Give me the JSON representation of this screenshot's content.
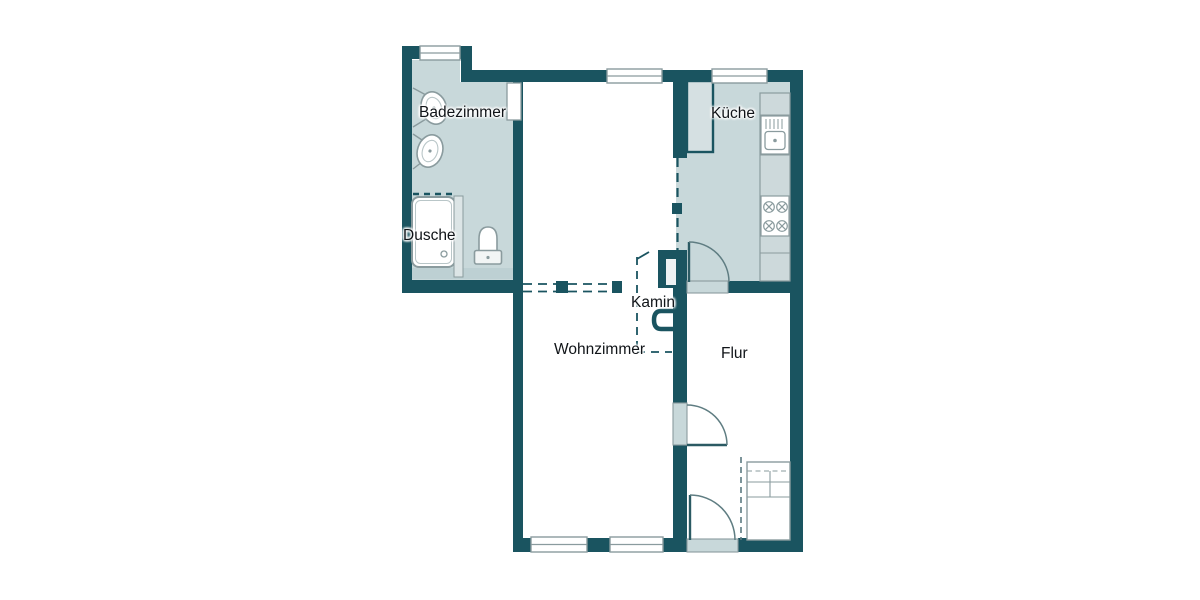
{
  "plan": {
    "type": "apartment-floor-plan",
    "labels": {
      "badezimmer": "Badezimmer",
      "dusche": "Dusche",
      "kueche": "Küche",
      "kamin": "Kamin",
      "wohnzimmer": "Wohnzimmer",
      "flur": "Flur"
    },
    "colors": {
      "wall": "#1a5460",
      "room_fill": "#c8d8da",
      "counter_fill": "#cdd9db",
      "niche_fill": "#d5e0e2",
      "fixture_outline": "#8a9b9e",
      "floor": "#ffffff",
      "text": "#101418"
    },
    "fixtures": [
      "washbasin",
      "washbasin",
      "shower-tray",
      "shower-glass-panel",
      "toilet",
      "interior-window",
      "kitchen-sink",
      "stove",
      "fireplace",
      "wardrobe",
      "kitchen-door",
      "hall-door",
      "entrance-door",
      "window",
      "window",
      "window",
      "window",
      "window"
    ]
  }
}
